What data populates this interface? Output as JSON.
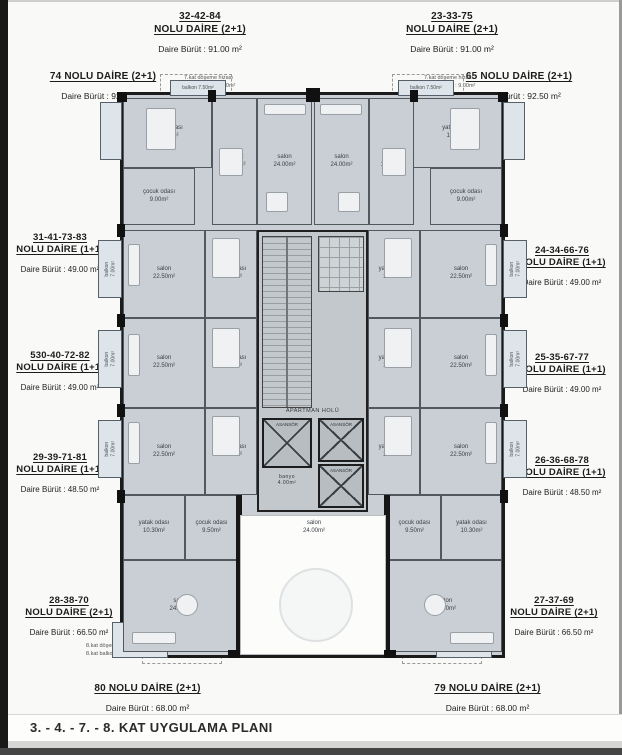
{
  "title": "3. - 4. - 7. - 8. KAT UYGULAMA PLANI",
  "units": {
    "u32": {
      "l1": "32-42-84",
      "l2": "NOLU DAİRE  (2+1)",
      "area": "Daire Bürüt  : 91.00 m²"
    },
    "u23": {
      "l1": "23-33-75",
      "l2": "NOLU DAİRE  (2+1)",
      "area": "Daire Bürüt  : 91.00 m²"
    },
    "u74": {
      "l1": "74 NOLU DAİRE  (2+1)",
      "area": "Daire Bürüt  : 92.50 m²"
    },
    "u65": {
      "l1": "65 NOLU DAİRE  (2+1)",
      "area": "Daire Bürüt  : 92.50 m²"
    },
    "u31": {
      "l1": "31-41-73-83",
      "l2": "NOLU DAİRE  (1+1)",
      "area": "Daire Bürüt  : 49.00 m²"
    },
    "u24": {
      "l1": "24-34-66-76",
      "l2": "NOLU DAİRE  (1+1)",
      "area": "Daire Bürüt  : 49.00 m²"
    },
    "u530": {
      "l1": "530-40-72-82",
      "l2": "NOLU DAİRE  (1+1)",
      "area": "Daire Bürüt  : 49.00 m²"
    },
    "u25": {
      "l1": "25-35-67-77",
      "l2": "NOLU DAİRE  (1+1)",
      "area": "Daire Bürüt  : 49.00 m²"
    },
    "u29": {
      "l1": "29-39-71-81",
      "l2": "NOLU DAİRE  (1+1)",
      "area": "Daire Bürüt  : 48.50 m²"
    },
    "u26": {
      "l1": "26-36-68-78",
      "l2": "NOLU DAİRE  (1+1)",
      "area": "Daire Bürüt  : 48.50 m²"
    },
    "u28": {
      "l1": "28-38-70",
      "l2": "NOLU DAİRE  (2+1)",
      "area": "Daire Bürüt  : 66.50 m²"
    },
    "u27": {
      "l1": "27-37-69",
      "l2": "NOLU DAİRE  (2+1)",
      "area": "Daire Bürüt  : 66.50 m²"
    },
    "u80": {
      "l1": "80 NOLU DAİRE  (2+1)",
      "area": "Daire Bürüt  : 68.00 m²"
    },
    "u79": {
      "l1": "79 NOLU DAİRE  (2+1)",
      "area": "Daire Bürüt  : 68.00 m²"
    }
  },
  "annotations": {
    "kat7": "7.kat döşeme hizası\n7.kat balkon : 9.00m²",
    "kat8": "8.kat döşeme hizası\n8.kat balkon : 7.50m²"
  },
  "rooms": {
    "yatak14": "yatak odası\n14.00m²",
    "cocuk9": "çocuk odası\n9.00m²",
    "mutfak12": "mutfak\n12.00m²",
    "salon24": "salon\n24.00m²",
    "salon225": "salon\n22.50m²",
    "yatak103": "yatak odası\n10.30m²",
    "cocuk95": "çocuk odası\n9.50m²",
    "balkon7": "balkon\n7.00m²",
    "balkon75": "balkon 7.50m²",
    "banyo4": "banyo\n4.00m²",
    "hol": "APARTMAN HOLÜ",
    "asansor": "ASANSÖR"
  },
  "colors": {
    "wall": "#1b1b1b",
    "room_fill": "#c9cfd4",
    "balcony_fill": "#dde4ea"
  }
}
